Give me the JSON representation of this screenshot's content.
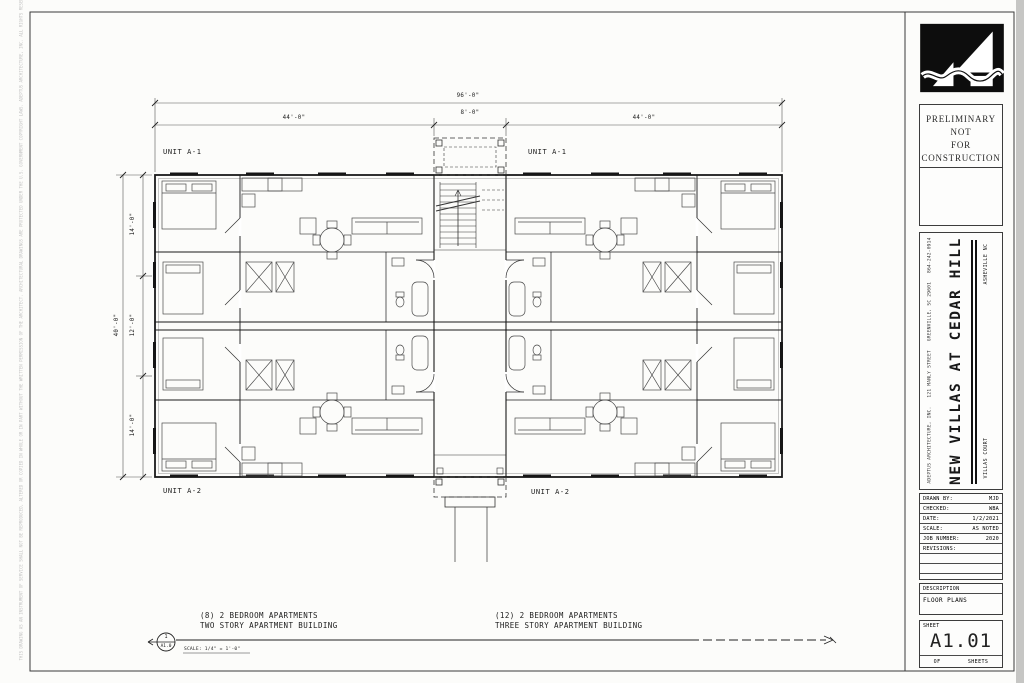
{
  "plan": {
    "units": {
      "top_left": "UNIT A-1",
      "top_right": "UNIT A-1",
      "bottom_left": "UNIT A-2",
      "bottom_right": "UNIT A-2"
    },
    "dims": {
      "top_overall": "96'-0\"",
      "top_left_seg": "44'-0\"",
      "top_center_seg": "8'-0\"",
      "top_right_seg": "44'-0\"",
      "left_overall": "40'-0\"",
      "left_top_seg": "14'-0\"",
      "left_mid_seg": "12'-0\"",
      "left_bot_seg": "14'-0\""
    },
    "notes": {
      "left_line1": "(8) 2 BEDROOM APARTMENTS",
      "left_line2": "TWO STORY APARTMENT BUILDING",
      "right_line1": "(12) 2 BEDROOM APARTMENTS",
      "right_line2": "THREE STORY APARTMENT BUILDING"
    },
    "bubble": {
      "number": "1",
      "sheet": "A1.0",
      "scale": "SCALE: 1/4\" = 1'-0\""
    }
  },
  "titleblock": {
    "stamp": [
      "PRELIMINARY",
      "NOT",
      "FOR",
      "CONSTRUCTION"
    ],
    "firm": "ADEPTUS ARCHITECTURE, INC.   121 MANLY STREET   GREENVILLE, SC 29601   864-242-0914",
    "project_title": "NEW VILLAS AT CEDAR HILL",
    "location": "ASHEVILLE NC",
    "subtitle": "VILLAS COURT",
    "rows": [
      {
        "label": "DRAWN BY:",
        "value": "MJD"
      },
      {
        "label": "CHECKED:",
        "value": "WBA"
      },
      {
        "label": "DATE:",
        "value": "1/2/2021"
      },
      {
        "label": "SCALE:",
        "value": "AS NOTED"
      },
      {
        "label": "JOB NUMBER:",
        "value": "2020"
      },
      {
        "label": "REVISIONS:",
        "value": ""
      }
    ],
    "description_label": "DESCRIPTION",
    "description": "FLOOR PLANS",
    "sheet_label": "SHEET",
    "sheet_number": "A1.01",
    "of_label": "OF",
    "sheets_label": "SHEETS"
  },
  "disclaimer": "THIS DRAWING AS AN INSTRUMENT OF SERVICE SHALL NOT BE REPRODUCED, ALTERED OR COPIED IN WHOLE OR IN PART WITHOUT THE WRITTEN PERMISSION OF THE ARCHITECT. ARCHITECTURAL DRAWINGS ARE PROTECTED UNDER THE U.S. GOVERNMENT COPYRIGHT LAWS. ADEPTUS ARCHITECTURE, INC. ALL RIGHTS RESERVED."
}
